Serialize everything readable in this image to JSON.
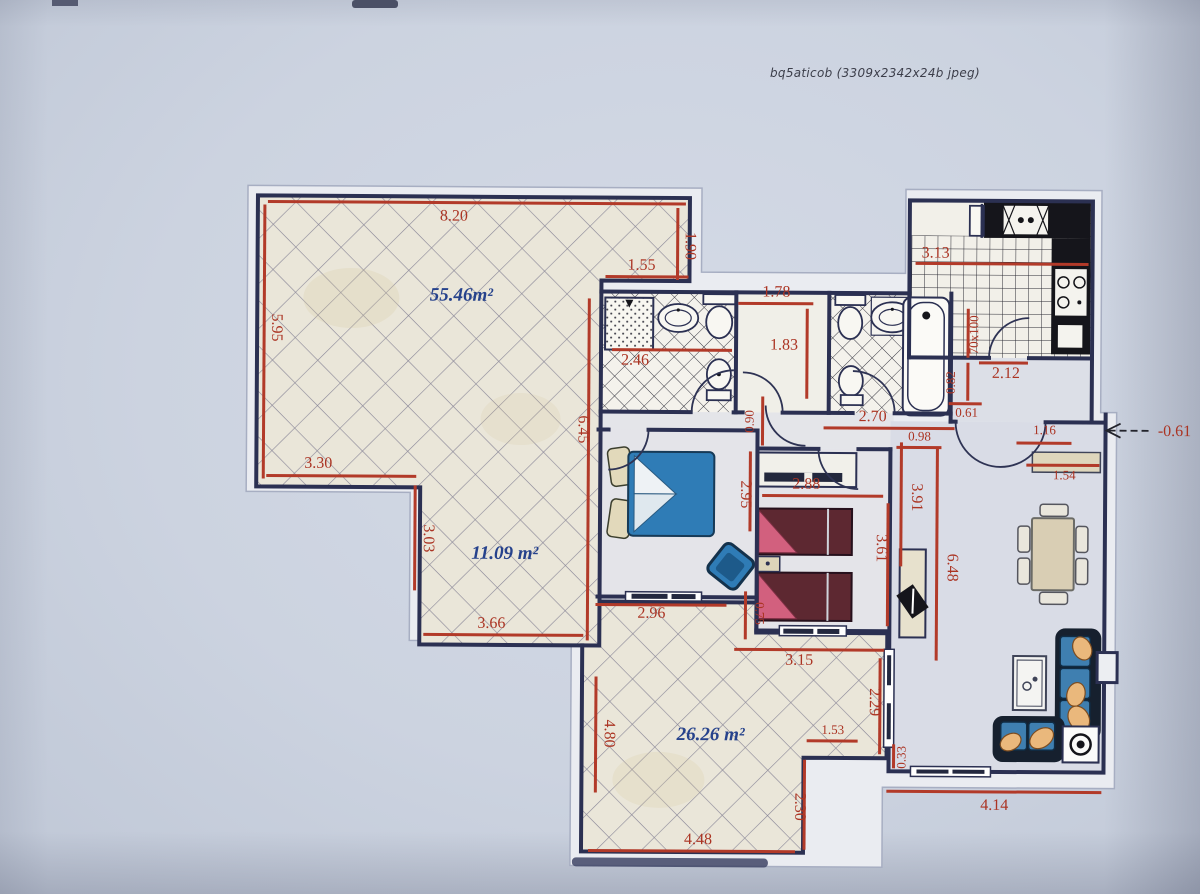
{
  "caption": "bq5aticob (3309x2342x24b jpeg)",
  "areas": {
    "top_terrace": "55.46m²",
    "mid_terrace": "11.09 m²",
    "bottom_terrace": "26.26 m²"
  },
  "dims": {
    "terrace_top": "8.20",
    "terrace_right": "1.90",
    "terrace_step": "1.55",
    "terrace_left": "5.95",
    "terrace_left_step": "3.30",
    "terrace_mid_right": "6.45",
    "terrace_mid_left": "3.03",
    "terrace_mid_bottom": "3.66",
    "bath1_width": "2.46",
    "dressing_top": "1.78",
    "dressing_side": "1.83",
    "hall_door": "0.90",
    "hall_width": "2.70",
    "bath2_exit": "0.61",
    "living_top_left": "0.98",
    "entry_width": "1.16",
    "entry_bench": "1.54",
    "entry_level": "-0.61",
    "bed1_depth": "2.95",
    "bed1_width": "2.96",
    "bed1_offset": "0.75",
    "bed2_width": "2.88",
    "bed2_depth": "3.61",
    "living_wall_upper": "3.91",
    "living_wall": "6.48",
    "terr_b_top": "3.15",
    "terr_b_right_up": "2.29",
    "living_step": "1.53",
    "living_corner": "0.33",
    "terr_b_left": "4.80",
    "terr_b_right": "2.30",
    "terr_b_bottom": "4.48",
    "living_bottom": "4.14",
    "kitchen_width": "3.13",
    "kitchen_door": "2.12",
    "kitchen_window": "70x100",
    "kitchen_side": "0.82"
  },
  "colors": {
    "paper": "#ccd3e0",
    "wall": "#2b3052",
    "dimension": "#b23a29",
    "area_label": "#26428c"
  }
}
